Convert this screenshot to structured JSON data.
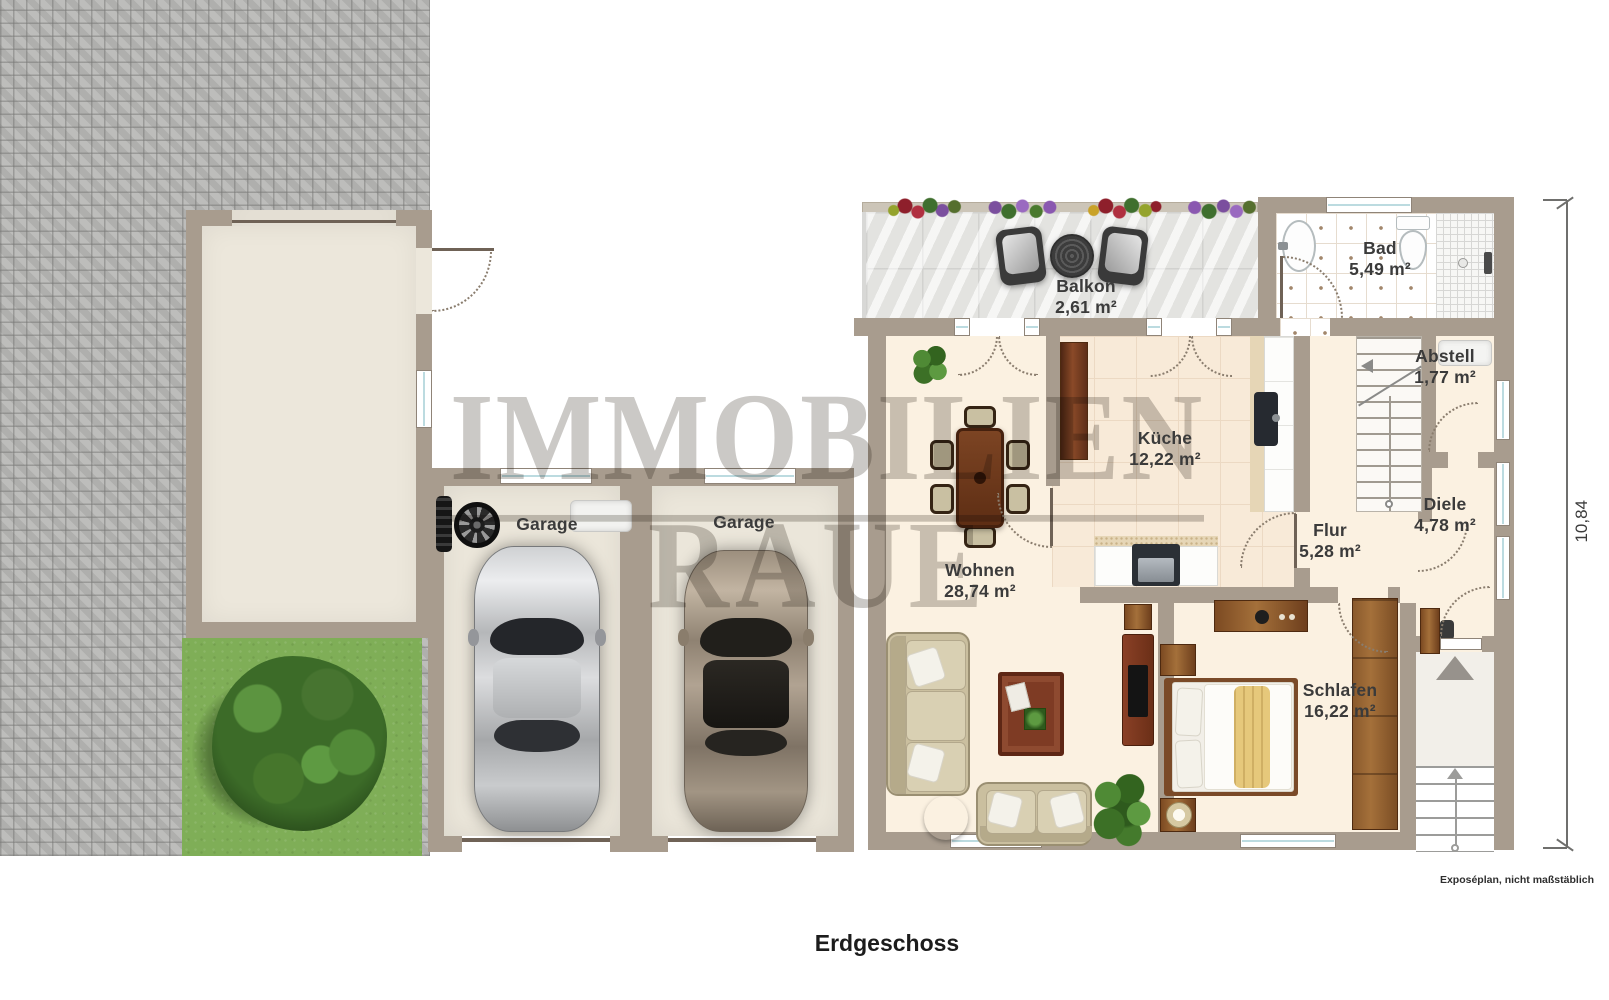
{
  "plan": {
    "title": "Erdgeschoss",
    "disclaimer": "Exposéplan, nicht maßstäblich",
    "watermark": {
      "line1": "IMMOBILIEN",
      "line2": "RAUE"
    },
    "dimension": {
      "height_label": "10,84"
    }
  },
  "rooms": [
    {
      "name": "Balkon",
      "area": "2,61 m²"
    },
    {
      "name": "Bad",
      "area": "5,49 m²"
    },
    {
      "name": "Abstell",
      "area": "1,77 m²"
    },
    {
      "name": "Küche",
      "area": "12,22 m²"
    },
    {
      "name": "Flur",
      "area": "5,28 m²"
    },
    {
      "name": "Diele",
      "area": "4,78 m²"
    },
    {
      "name": "Wohnen",
      "area": "28,74 m²"
    },
    {
      "name": "Schlafen",
      "area": "16,22 m²"
    },
    {
      "name": "Garage"
    },
    {
      "name": "Garage"
    }
  ],
  "colors": {
    "wall": "#a89c8e",
    "floor_cream": "#fbf1e1",
    "kitchen_tile": "#f8ead8",
    "garage_floor": "#ebe6da",
    "balcony_tile": "#eaeae8",
    "paving": "#b8b8b6",
    "lawn": "#7fae57",
    "watermark": "#cbc9c6",
    "label_text": "#3b3b3b"
  }
}
